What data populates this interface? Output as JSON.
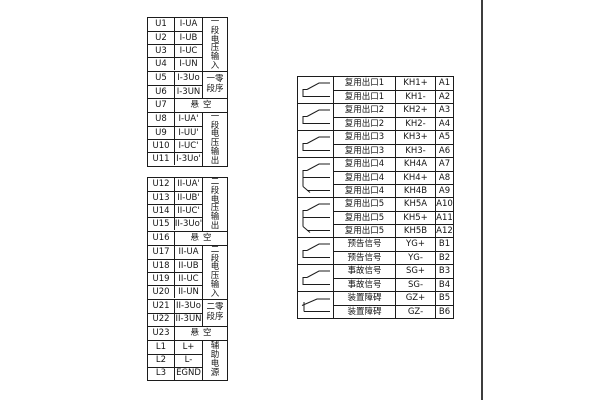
{
  "page": {
    "background": "#ffffff",
    "line_color": "#1c1c1c",
    "edge_line_color": "#3d3d3d",
    "empty_label": "悬空"
  },
  "left_tables": [
    {
      "name": "voltage-terminal-table-1",
      "groups": [
        {
          "label": "一段电压输入",
          "label_layout": "vertical",
          "rows": [
            {
              "terminal": "U1",
              "signal": "I-UA"
            },
            {
              "terminal": "U2",
              "signal": "I-UB"
            },
            {
              "terminal": "U3",
              "signal": "I-UC"
            },
            {
              "terminal": "U4",
              "signal": "I-UN"
            }
          ]
        },
        {
          "label": "一零\n段序",
          "label_layout": "two-line",
          "rows": [
            {
              "terminal": "U5",
              "signal": "I-3Uo"
            },
            {
              "terminal": "U6",
              "signal": "I-3UN"
            }
          ]
        },
        {
          "span": true,
          "rows": [
            {
              "terminal": "U7",
              "signal": "悬空"
            }
          ]
        },
        {
          "label": "一段电压输出",
          "label_layout": "vertical",
          "rows": [
            {
              "terminal": "U8",
              "signal": "I-UA'"
            },
            {
              "terminal": "U9",
              "signal": "I-UU'"
            },
            {
              "terminal": "U10",
              "signal": "I-UC'"
            },
            {
              "terminal": "U11",
              "signal": "I-3Uo'"
            }
          ]
        }
      ]
    },
    {
      "name": "voltage-terminal-table-2",
      "groups": [
        {
          "label": "二段电压输出",
          "label_layout": "vertical",
          "rows": [
            {
              "terminal": "U12",
              "signal": "II-UA'"
            },
            {
              "terminal": "U13",
              "signal": "II-UB'"
            },
            {
              "terminal": "U14",
              "signal": "II-UC'"
            },
            {
              "terminal": "U15",
              "signal": "II-3Uo'"
            }
          ]
        },
        {
          "span": true,
          "rows": [
            {
              "terminal": "U16",
              "signal": "悬空"
            }
          ]
        },
        {
          "label": "二段电压输入",
          "label_layout": "vertical",
          "rows": [
            {
              "terminal": "U17",
              "signal": "II-UA"
            },
            {
              "terminal": "U18",
              "signal": "II-UB"
            },
            {
              "terminal": "U19",
              "signal": "II-UC"
            },
            {
              "terminal": "U20",
              "signal": "II-UN"
            }
          ]
        },
        {
          "label": "二零\n段序",
          "label_layout": "two-line",
          "rows": [
            {
              "terminal": "U21",
              "signal": "II-3Uo"
            },
            {
              "terminal": "U22",
              "signal": "II-3UN"
            }
          ]
        },
        {
          "span": true,
          "rows": [
            {
              "terminal": "U23",
              "signal": "悬空"
            }
          ]
        },
        {
          "label": "辅助电源",
          "label_layout": "vertical",
          "rows": [
            {
              "terminal": "L1",
              "signal": "L+"
            },
            {
              "terminal": "L2",
              "signal": "L-"
            },
            {
              "terminal": "L3",
              "signal": "EGND"
            }
          ]
        }
      ]
    }
  ],
  "right_table": {
    "name": "output-signal-terminal-table",
    "groups": [
      {
        "symbol": "normally-open",
        "rows": [
          {
            "label": "复用出口1",
            "code": "KH1+",
            "terminal": "A1"
          },
          {
            "label": "复用出口1",
            "code": "KH1-",
            "terminal": "A2"
          }
        ]
      },
      {
        "symbol": "normally-open",
        "rows": [
          {
            "label": "复用出口2",
            "code": "KH2+",
            "terminal": "A3"
          },
          {
            "label": "复用出口2",
            "code": "KH2-",
            "terminal": "A4"
          }
        ]
      },
      {
        "symbol": "normally-open",
        "rows": [
          {
            "label": "复用出口3",
            "code": "KH3+",
            "terminal": "A5"
          },
          {
            "label": "复用出口3",
            "code": "KH3-",
            "terminal": "A6"
          }
        ]
      },
      {
        "symbol": "changeover",
        "rows": [
          {
            "label": "复用出口4",
            "code": "KH4A",
            "terminal": "A7"
          },
          {
            "label": "复用出口4",
            "code": "KH4+",
            "terminal": "A8"
          },
          {
            "label": "复用出口4",
            "code": "KH4B",
            "terminal": "A9"
          }
        ]
      },
      {
        "symbol": "changeover",
        "rows": [
          {
            "label": "复用出口5",
            "code": "KH5A",
            "terminal": "A10"
          },
          {
            "label": "复用出口5",
            "code": "KH5+",
            "terminal": "A11"
          },
          {
            "label": "复用出口5",
            "code": "KH5B",
            "terminal": "A12"
          }
        ]
      },
      {
        "symbol": "normally-open",
        "rows": [
          {
            "label": "预告信号",
            "code": "YG+",
            "terminal": "B1"
          },
          {
            "label": "预告信号",
            "code": "YG-",
            "terminal": "B2"
          }
        ]
      },
      {
        "symbol": "normally-open",
        "rows": [
          {
            "label": "事故信号",
            "code": "SG+",
            "terminal": "B3"
          },
          {
            "label": "事故信号",
            "code": "SG-",
            "terminal": "B4"
          }
        ]
      },
      {
        "symbol": "normally-closed",
        "rows": [
          {
            "label": "装置障碍",
            "code": "GZ+",
            "terminal": "B5"
          },
          {
            "label": "装置障碍",
            "code": "GZ-",
            "terminal": "B6"
          }
        ]
      }
    ]
  }
}
